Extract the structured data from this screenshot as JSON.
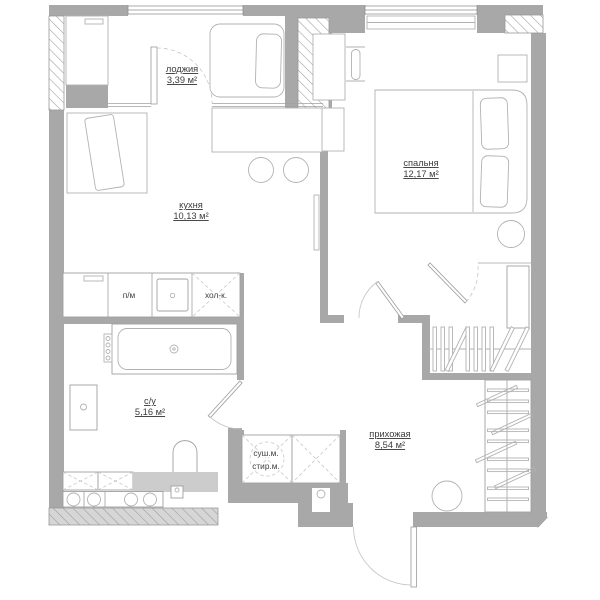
{
  "plan": {
    "rooms": {
      "loggia": {
        "name": "лоджия",
        "area": "3,39 м²"
      },
      "kitchen": {
        "name": "кухня",
        "area": "10,13 м²"
      },
      "bedroom": {
        "name": "спальня",
        "area": "12,17 м²"
      },
      "bathroom": {
        "name": "с/у",
        "area": "5,16 м²"
      },
      "hallway": {
        "name": "прихожая",
        "area": "8,54 м²"
      }
    },
    "appliances": {
      "dishwasher": "п/м",
      "fridge": "хол-к.",
      "dryer": "суш.м.",
      "washer": "стир.м."
    },
    "colors": {
      "wall": "#a8a8a8",
      "hatch_line": "#9a9a9a",
      "furniture_line": "#b2b2b2",
      "fixture_line": "#a0a0a0",
      "panel": "#cccccc",
      "text": "#3c3c3c",
      "background": "#ffffff"
    }
  }
}
